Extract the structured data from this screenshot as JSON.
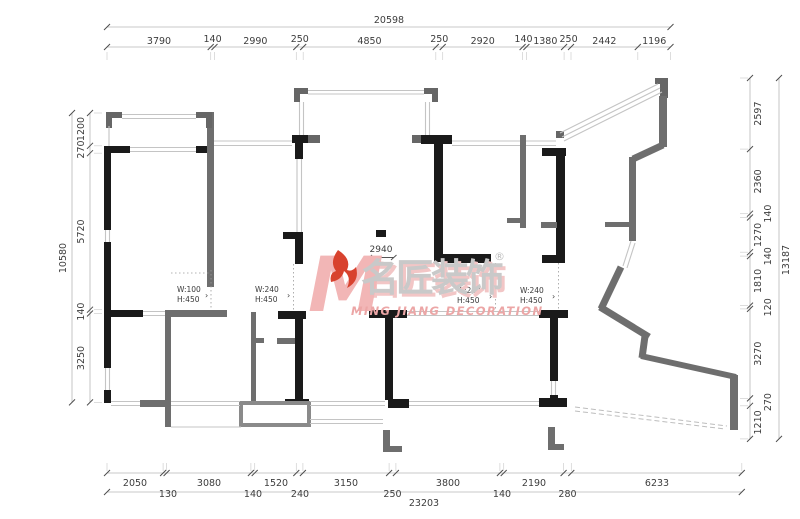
{
  "watermark": {
    "letter": "M",
    "cn": "名匠装饰",
    "reg": "®",
    "en": "MING JIANG DECORATION",
    "pink": "#f2b6b6",
    "red": "#d8422e",
    "gray": "#c9c9c9"
  },
  "dims": {
    "top": {
      "overall": "20598",
      "segments": [
        "3790",
        "140",
        "2990",
        "250",
        "4850",
        "250",
        "2920",
        "140",
        "1380",
        "250",
        "2442",
        "1196"
      ]
    },
    "bottom": {
      "overall": "23203",
      "row1": [
        "2050",
        "3080",
        "1520",
        "3150",
        "3800",
        "2190",
        "6233"
      ],
      "row2": [
        "130",
        "140",
        "240",
        "250",
        "140",
        "280"
      ]
    },
    "left": {
      "overall": "10580",
      "segments": [
        "1200",
        "270",
        "5720",
        "140",
        "3250"
      ]
    },
    "right": {
      "overall": "13187",
      "segments": [
        "2597",
        "2360",
        "140",
        "1270",
        "140",
        "1810",
        "120",
        "3270",
        "270",
        "1210"
      ]
    }
  },
  "annotations": {
    "interior_dim": "2940",
    "openings": [
      {
        "w": "W:100",
        "h": "H:450"
      },
      {
        "w": "W:240",
        "h": "H:450"
      },
      {
        "w": "W:240",
        "h": "H:450"
      },
      {
        "w": "W:240",
        "h": "H:450"
      }
    ],
    "arrow": "›"
  },
  "colors": {
    "wall_black": "#1a1a1a",
    "wall_gray": "#6e6e6e",
    "corner_gray": "#666666",
    "dim_text": "#3d3d3d"
  }
}
